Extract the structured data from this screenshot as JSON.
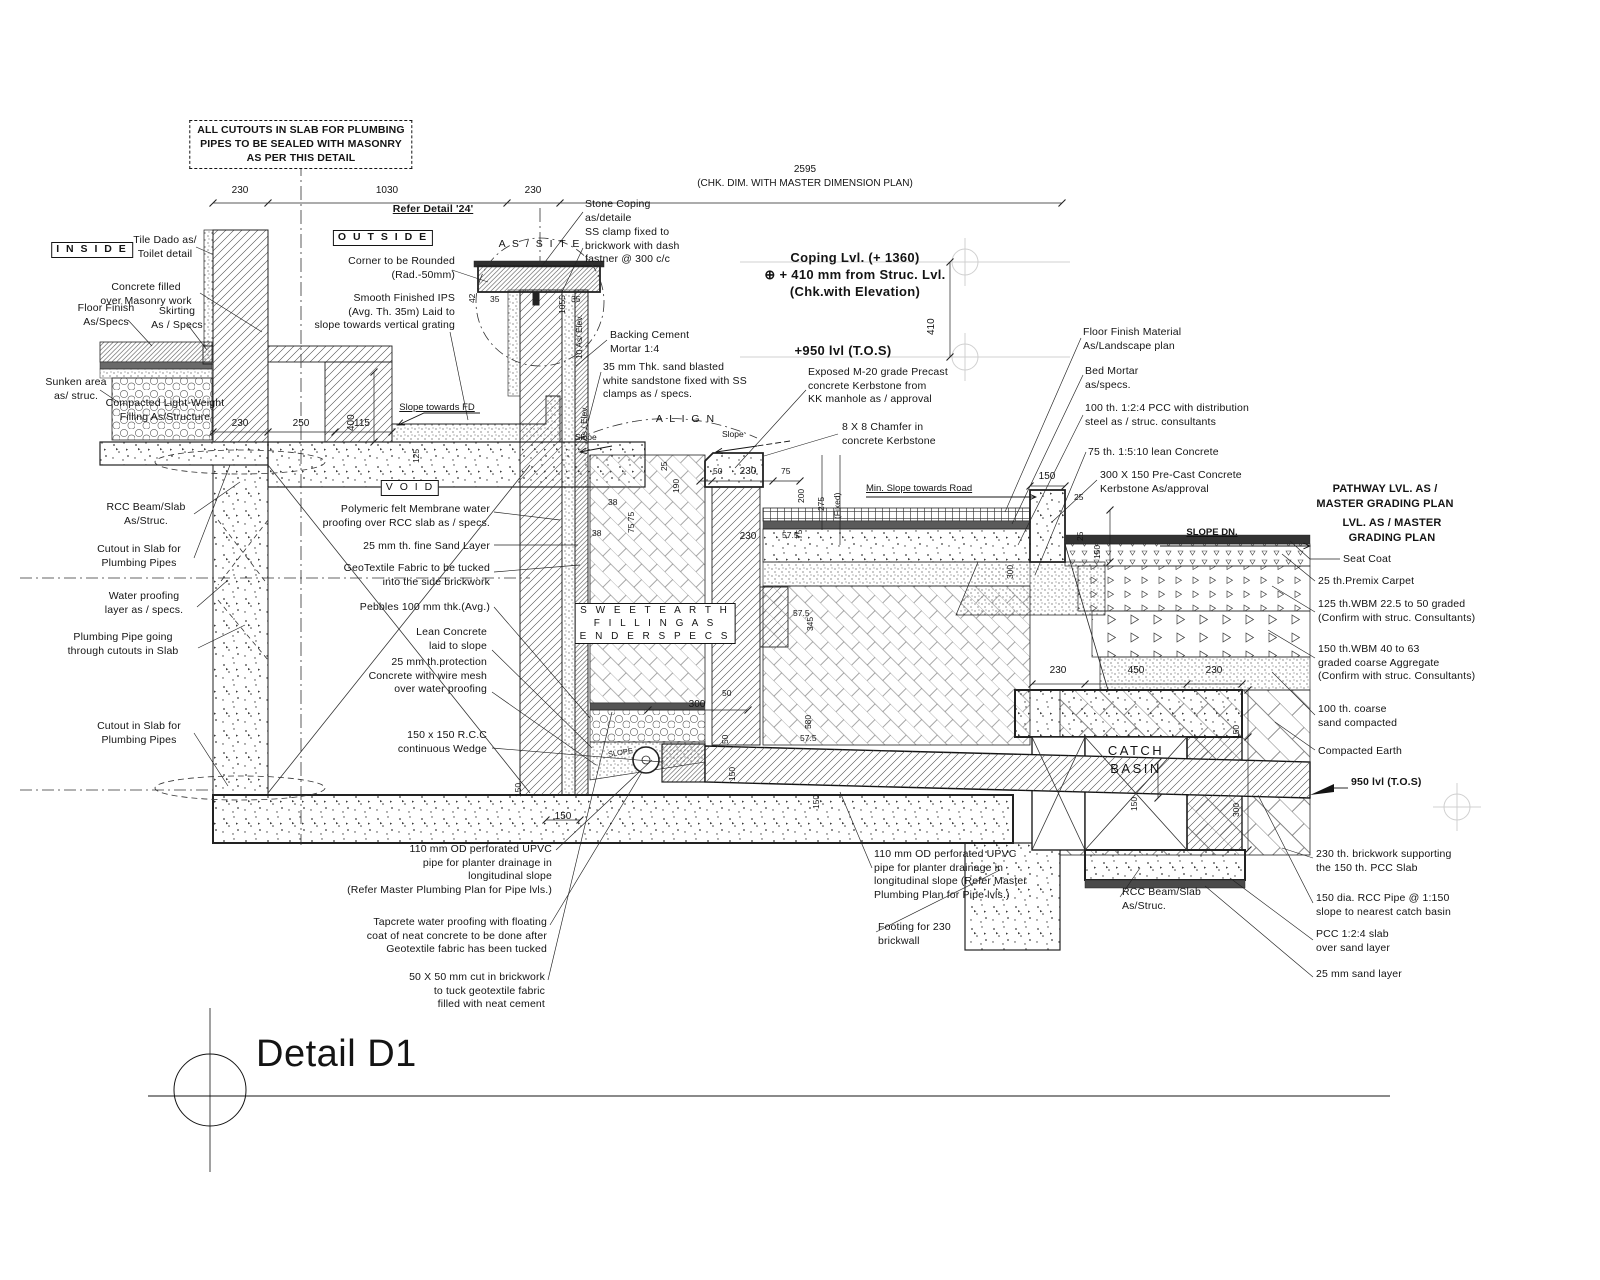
{
  "meta": {
    "drawing_title": "Detail D1",
    "type": "construction-section-detail"
  },
  "colors": {
    "ink": "#141414",
    "dark_band": "#3a3a3a",
    "faint": "#d0d0d0"
  },
  "labels": {
    "top_note": "ALL CUTOUTS IN SLAB FOR PLUMBING\nPIPES TO BE SEALED WITH MASONRY\nAS PER THIS DETAIL",
    "refer_detail": "Refer Detail '24'",
    "inside": "I N S I D E",
    "outside": "O U T S I D E",
    "as_site": "A S   /   S I T E",
    "align": "A L I G N",
    "void": "V O I D",
    "sweet_earth": "S W E E T   E A R T H\nF I L L I N G   A S\nE N D E R   S P E C S",
    "catch_basin": "CATCH\nBASIN",
    "tile_dado": "Tile Dado as/\nToilet detail",
    "corner_rounded": "Corner to be Rounded\n(Rad.-50mm)",
    "smooth_ips": "Smooth Finished IPS\n(Avg. Th. 35m) Laid to\nslope towards vertical grating",
    "concrete_filled": "Concrete filled\nover Masonry work",
    "floor_finish": "Floor Finish\nAs/Specs",
    "skirting": "Skirting\nAs / Specs",
    "sunken_area": "Sunken area\nas/ struc.",
    "compacted_lw": "Compacted Light-Weight\nFilling As/Structure",
    "stone_coping": "Stone Coping\nas/detaile",
    "ss_clamp": "SS clamp fixed to\nbrickwork with dash\nfastner @ 300 c/c",
    "backing_mortar": "Backing Cement\nMortar 1:4",
    "sandstone35": "35 mm Thk. sand blasted\nwhite sandstone fixed with SS\nclamps as / specs.",
    "coping_lvl": "Coping Lvl. (+ 1360)\n⊕ + 410 mm from Struc. Lvl.\n(Chk.with Elevation)",
    "tos950_c": "+950 lvl (T.O.S)",
    "tos950_r": "950 lvl (T.O.S)",
    "exposed_kerb": "Exposed M-20 grade Precast\nconcrete Kerbstone from\nKK manhole as / approval",
    "chamfer": "8 X 8 Chamfer in\nconcrete Kerbstone",
    "min_slope_road": "Min. Slope towards Road",
    "slope_left": "Slope",
    "slope_right": "Slope",
    "slope_fd": "Slope towards FD",
    "slope_small": "SLOPE",
    "slope_dn": "SLOPE DN.",
    "polymeric": "Polymeric felt Membrane water\nproofing over RCC slab as / specs.",
    "fine_sand_25": "25 mm th. fine Sand Layer",
    "geotextile": "GeoTextile Fabric to be tucked\ninto the side brickwork",
    "pebbles100": "Pebbles 100 mm thk.(Avg.)",
    "lean_concrete": "Lean Concrete\nlaid to slope",
    "protection25": "25 mm th.protection\nConcrete with wire mesh\nover water proofing",
    "rcc_wedge": "150 x 150 R.C.C\ncontinuous Wedge",
    "rcc_beam_left": "RCC Beam/Slab\nAs/Struc.",
    "rcc_beam_right": "RCC Beam/Slab\nAs/Struc.",
    "cutout_slab_1": "Cutout in Slab for\nPlumbing Pipes",
    "cutout_slab_2": "Cutout in Slab for\nPlumbing Pipes",
    "waterproof_layer": "Water proofing\nlayer as / specs.",
    "plumbing_pipe": "Plumbing Pipe going\nthrough cutouts in Slab",
    "floor_finish_material": "Floor Finish Material\nAs/Landscape plan",
    "bed_mortar": "Bed Mortar\nas/specs.",
    "pcc_100": "100 th. 1:2:4 PCC with distribution\nsteel as / struc. consultants",
    "lean_75": "75 th. 1:5:10 lean Concrete",
    "kerb_300x150": "300 X 150 Pre-Cast Concrete\nKerbstone As/approval",
    "pathway_lvl_hdr": "PATHWAY LVL. AS /\nMASTER GRADING PLAN",
    "lvl_master_hdr": "LVL. AS / MASTER\nGRADING PLAN",
    "seat_coat": "Seat Coat",
    "premix_carpet": "25 th.Premix Carpet",
    "wbm_125": "125 th.WBM 22.5 to 50 graded\n(Confirm with struc. Consultants)",
    "wbm_150": "150 th.WBM 40 to 63\ngraded coarse Aggregate\n(Confirm with struc. Consultants)",
    "coarse_sand_100": "100 th. coarse\nsand compacted",
    "compacted_earth": "Compacted Earth",
    "brickwork_230": "230 th. brickwork supporting\nthe 150 th. PCC Slab",
    "rcc_pipe_150": "150 dia. RCC Pipe @ 1:150\nslope to nearest catch basin",
    "pcc_124_slab": "PCC 1:2:4 slab\nover sand layer",
    "sand_layer_25": "25 mm sand layer",
    "upvc_left": "110 mm OD perforated UPVC\npipe for planter drainage in\nlongitudinal slope\n(Refer Master Plumbing Plan for Pipe lvls.)",
    "tapcrete": "Tapcrete water proofing with floating\ncoat of neat concrete to be done after\nGeotextile fabric has been tucked",
    "cut_50x50": "50 X 50 mm cut in brickwork\nto tuck geotextile fabric\nfilled with neat cement",
    "upvc_right": "110 mm OD perforated UPVC\npipe for planter drainage in\nlongitudinal slope (Refer Master\nPlumbing Plan for Pipe lvls.)",
    "footing_230": "Footing for 230\nbrickwall",
    "detail_title": "Detail D1"
  },
  "dims": {
    "d2595": "2595",
    "chk": "(CHK. DIM. WITH MASTER DIMENSION PLAN)",
    "d230": "230",
    "d1030": "1030",
    "d250": "250",
    "d115": "115",
    "d400": "400",
    "d410": "410",
    "d125": "125",
    "d1055": "1055",
    "elev10": "10 As/ Elev.",
    "elev_as": "As / Elev.",
    "d35": "35",
    "d42": "42",
    "d25": "25",
    "d190": "190",
    "d50": "50",
    "d75": "75",
    "d200": "200",
    "d275": "275",
    "fixed": "(Fixed)",
    "d38": "38",
    "d7575": "75  75",
    "d575": "57.5",
    "d345": "345",
    "d580": "580",
    "d300": "300",
    "d150": "150",
    "d450": "450"
  }
}
